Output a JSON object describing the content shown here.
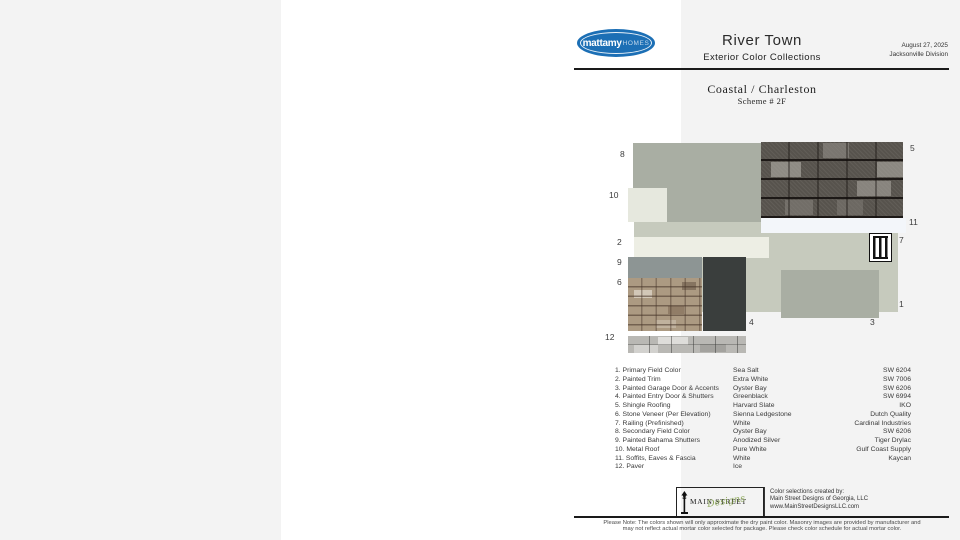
{
  "header": {
    "logo": {
      "brand_bold": "mattamy",
      "brand_light": "HOMES"
    },
    "title": "River Town",
    "subtitle": "Exterior Color Collections",
    "date": "August 27, 2025",
    "division": "Jacksonville Division"
  },
  "scheme": {
    "collection": "Coastal / Charleston",
    "scheme_number": "Scheme # 2F"
  },
  "board": {
    "labels": {
      "l1": "1",
      "l2": "2",
      "l3": "3",
      "l4": "4",
      "l5": "5",
      "l6": "6",
      "l7": "7",
      "l8": "8",
      "l9": "9",
      "l10": "10",
      "l11": "11",
      "l12": "12"
    }
  },
  "legend": {
    "rows": [
      {
        "item": "1. Primary Field Color",
        "color": "Sea Salt",
        "source": "SW 6204"
      },
      {
        "item": "2. Painted Trim",
        "color": "Extra White",
        "source": "SW 7006"
      },
      {
        "item": "3. Painted Garage Door & Accents",
        "color": "Oyster Bay",
        "source": "SW 6206"
      },
      {
        "item": "4. Painted Entry Door & Shutters",
        "color": "Greenblack",
        "source": "SW 6994"
      },
      {
        "item": "5. Shingle Roofing",
        "color": "Harvard Slate",
        "source": "IKO"
      },
      {
        "item": "6. Stone Veneer (Per Elevation)",
        "color": "Sienna Ledgestone",
        "source": "Dutch Quality"
      },
      {
        "item": "7. Railing (Prefinished)",
        "color": "White",
        "source": "Cardinal Industries"
      },
      {
        "item": "8. Secondary Field Color",
        "color": "Oyster Bay",
        "source": "SW 6206"
      },
      {
        "item": "9. Painted Bahama Shutters",
        "color": "Anodized Silver",
        "source": "Tiger Drylac"
      },
      {
        "item": "10. Metal Roof",
        "color": "Pure White",
        "source": "Gulf Coast Supply"
      },
      {
        "item": "11. Soffits, Eaves & Fascia",
        "color": "White",
        "source": "Kaycan"
      },
      {
        "item": "12. Paver",
        "color": "Ice",
        "source": ""
      }
    ]
  },
  "footer": {
    "designer_logo": {
      "main": "MAIN STREET",
      "script": "Designs"
    },
    "credit_line1": "Color selections created by:",
    "credit_line2": "Main Street Designs of Georgia, LLC",
    "credit_line3": "www.MainStreetDesignsLLC.com",
    "disclaimer_line1": "Please Note: The colors shown will only approximate the dry paint color. Masonry images are provided by manufacturer and",
    "disclaimer_line2": "may not reflect actual mortar color selected for package. Please check color schedule for actual mortar color."
  },
  "palette": {
    "sea_salt": "#c6cabd",
    "oyster_bay": "#a9aea3",
    "extra_white": "#edeee4",
    "pure_white": "#e6e8de",
    "anodized_silver": "#8d9594",
    "greenblack": "#3a3e3d",
    "soffit_white": "#f3f6fa",
    "brand_blue": "#1c6fb5",
    "logo_green": "#7d9c42"
  }
}
